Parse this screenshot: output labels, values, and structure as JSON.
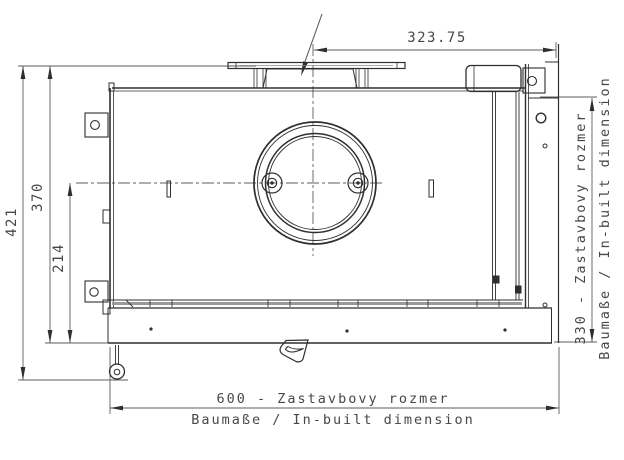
{
  "drawing": {
    "type": "technical-dimension-drawing",
    "dimensions": {
      "top_width": "323.75",
      "total_height": "421",
      "upper_height": "370",
      "lower_height": "214",
      "right_depth": "330 - Zastavbovy rozmer",
      "right_depth_sub": "Baumaße / In-built dimension",
      "bottom_width": "600 - Zastavbovy rozmer",
      "bottom_width_sub": "Baumaße / In-built dimension"
    },
    "colors": {
      "object_line": "#2f2f2f",
      "dimension_line": "#5c5c5c",
      "text": "#474747",
      "background": "#ffffff"
    }
  }
}
